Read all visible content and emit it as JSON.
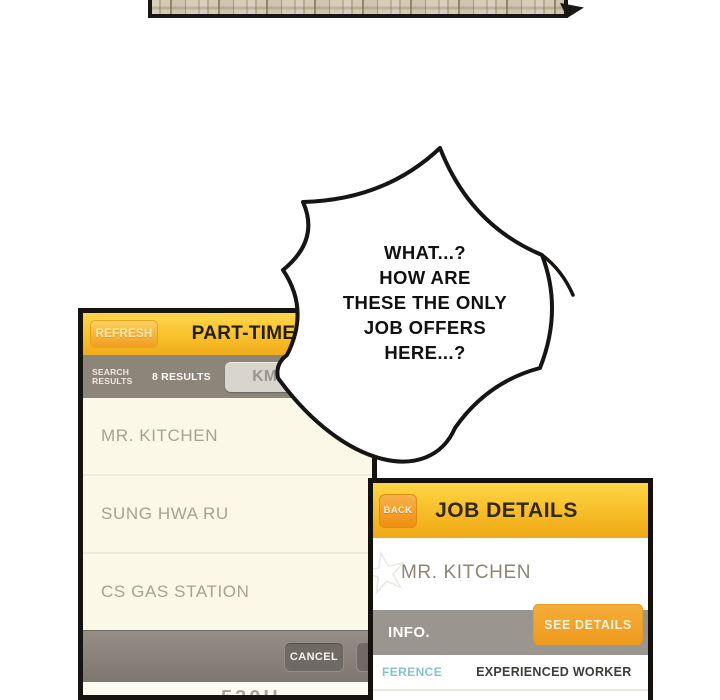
{
  "top_panel": {
    "description": "cut-off building panel strip"
  },
  "speech_bubble": {
    "lines": [
      "WHAT...?",
      "HOW ARE",
      "THESE THE ONLY",
      "JOB OFFERS",
      "HERE...?"
    ]
  },
  "search_app": {
    "refresh_label": "REFRESH",
    "title": "PART-TIME",
    "search_results_label": "SEARCH RESULTS",
    "results_count": "8 RESULTS",
    "distance_button": "KM",
    "listings": [
      "MR. KITCHEN",
      "SUNG HWA RU",
      "CS GAS STATION"
    ],
    "cancel_label": "CANCEL",
    "footer_partial_text": "530H"
  },
  "details_app": {
    "back_label": "BACK",
    "title": "JOB DETAILS",
    "business_name": "MR. KITCHEN",
    "info_label": "INFO.",
    "see_details_label": "SEE DETAILS",
    "preference_label": "FERENCE",
    "preference_value": "EXPERIENCED WORKER"
  },
  "icons": {
    "star_glyph": "☆"
  },
  "colors": {
    "header_yellow_top": "#fed54c",
    "header_yellow_bottom": "#f0ab1b",
    "orange_button": "#ee9a1d",
    "bar_gray": "#8b857a",
    "info_bar_gray": "#9a958e",
    "list_cream": "#faf6e3",
    "listing_text": "#a8a192",
    "preference_blue": "#84c2d7",
    "outline_black": "#171513"
  }
}
